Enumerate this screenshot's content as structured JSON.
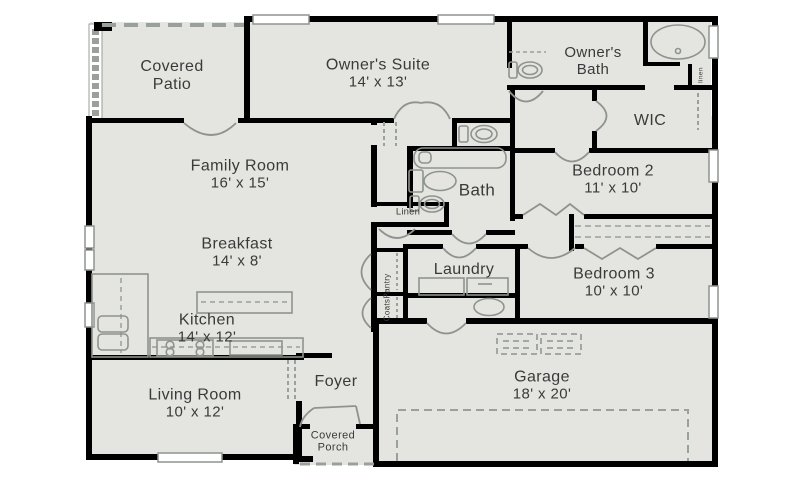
{
  "colors": {
    "floor": "#e4e5e0",
    "wall": "#000000",
    "fixture_line": "#8f938e",
    "dash_line": "#9aa09a",
    "text": "#3a3a3a",
    "background": "#ffffff"
  },
  "rooms": {
    "covered_patio": {
      "name": "Covered Patio"
    },
    "owners_suite": {
      "name": "Owner's Suite",
      "dims": "14' x 13'"
    },
    "owners_bath": {
      "name": "Owner's Bath"
    },
    "linen_upper": {
      "name": "linen"
    },
    "wic": {
      "name": "WIC"
    },
    "family_room": {
      "name": "Family Room",
      "dims": "16' x 15'"
    },
    "bath": {
      "name": "Bath"
    },
    "linen": {
      "name": "Linen"
    },
    "bedroom_2": {
      "name": "Bedroom 2",
      "dims": "11' x 10'"
    },
    "breakfast": {
      "name": "Breakfast",
      "dims": "14' x 8'"
    },
    "laundry": {
      "name": "Laundry"
    },
    "pantry": {
      "name": "Pantry"
    },
    "coats": {
      "name": "Coats"
    },
    "bedroom_3": {
      "name": "Bedroom 3",
      "dims": "10' x 10'"
    },
    "kitchen": {
      "name": "Kitchen",
      "dims": "14' x 12'"
    },
    "living_room": {
      "name": "Living Room",
      "dims": "10' x 12'"
    },
    "foyer": {
      "name": "Foyer"
    },
    "covered_porch": {
      "name": "Covered Porch"
    },
    "garage": {
      "name": "Garage",
      "dims": "18' x 20'"
    }
  },
  "fixtures": [
    "round-shower",
    "toilet",
    "bathtub",
    "vanity-sink",
    "pedestal-sink",
    "kitchen-sink",
    "refrigerator",
    "range-burners",
    "dishwasher",
    "island",
    "washer",
    "dryer",
    "utility-basin",
    "garage-door",
    "closet-rod",
    "shelves",
    "window",
    "door-swing",
    "bifold-door",
    "screened-wall"
  ]
}
